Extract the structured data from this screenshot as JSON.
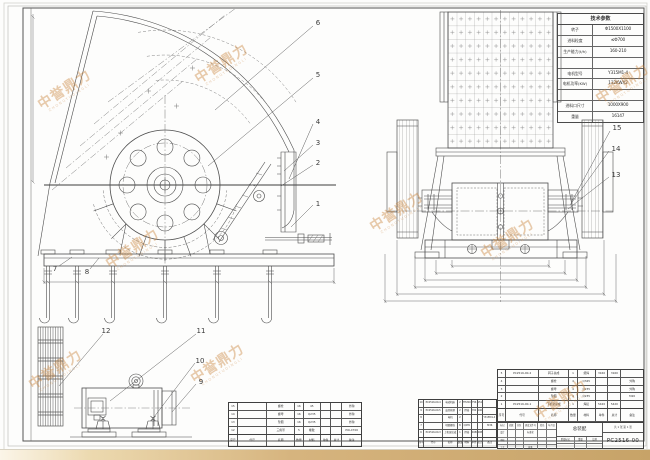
{
  "params": {
    "title": "技术参数",
    "rows": [
      {
        "label": "转子",
        "value": "Φ1500X1100"
      },
      {
        "label": "进料粒度",
        "value": "≤Φ700"
      },
      {
        "label": "生产能力(t/h)",
        "value": "160-210"
      },
      {
        "label": "",
        "value": ""
      },
      {
        "label": "电机型号",
        "value": "Y315M1-4"
      },
      {
        "label": "电机功率(KW)",
        "value": "132KWX2"
      },
      {
        "label": "",
        "value": ""
      },
      {
        "label": "进料口尺寸",
        "value": "1000X900"
      },
      {
        "label": "重量",
        "value": "16147"
      }
    ]
  },
  "bom_header": [
    "序号",
    "代号",
    "名称",
    "数量",
    "材料",
    "单件",
    "总计",
    "备注"
  ],
  "bom_left": {
    "rows": [
      {
        "no": "15",
        "code": "",
        "name": "螺栓",
        "qty": "16",
        "mat": "45",
        "w1": "",
        "w2": "",
        "note": "外购"
      },
      {
        "no": "14",
        "code": "",
        "name": "螺母",
        "qty": "16",
        "mat": "Q235",
        "w1": "",
        "w2": "",
        "note": "外购"
      },
      {
        "no": "13",
        "code": "",
        "name": "垫圈",
        "qty": "16",
        "mat": "Q235",
        "w1": "",
        "w2": "",
        "note": "外购"
      },
      {
        "no": "12",
        "code": "",
        "name": "三角带",
        "qty": "5",
        "mat": "橡胶",
        "w1": "",
        "w2": "",
        "note": "POLX700"
      }
    ]
  },
  "bom_mid": {
    "rows": [
      {
        "no": "10",
        "code": "PC2516-00-4",
        "name": "电动机座",
        "qty": "2",
        "mat": "HT200",
        "w1": "756",
        "w2": "1512",
        "note": ""
      },
      {
        "no": "9",
        "code": "PC2516-00-5",
        "name": "皮带轮罩",
        "qty": "2",
        "mat": "焊接",
        "w1": "702",
        "w2": "1404",
        "note": ""
      },
      {
        "no": "8",
        "code": "",
        "name": "电机",
        "qty": "2",
        "mat": "",
        "w1": "",
        "w2": "",
        "note": "Y315M1-4 132KW"
      },
      {
        "no": "7",
        "code": "",
        "name": "地脚螺栓",
        "qty": "8",
        "mat": "Q235",
        "w1": "",
        "w2": "",
        "note": "M36"
      },
      {
        "no": "6",
        "code": "PC2516-00-3",
        "name": "上机架总成",
        "qty": "1",
        "mat": "焊接",
        "w1": "4080",
        "w2": "4080",
        "note": ""
      }
    ]
  },
  "bom_right": {
    "rows": [
      {
        "no": "5",
        "code": "PC2516-00-2",
        "name": "转子总成",
        "qty": "1",
        "mat": "组焊",
        "w1": "3160",
        "w2": "3160",
        "note": ""
      },
      {
        "no": "4",
        "code": "",
        "name": "螺栓",
        "qty": "4",
        "mat": "Q345",
        "w1": "",
        "w2": "",
        "note": "外购"
      },
      {
        "no": "3",
        "code": "",
        "name": "螺母",
        "qty": "4",
        "mat": "Q235",
        "w1": "",
        "w2": "",
        "note": "外购"
      },
      {
        "no": "2",
        "code": "",
        "name": "垫圈",
        "qty": "4",
        "mat": "Q235",
        "w1": "",
        "w2": "",
        "note": "M20"
      },
      {
        "no": "1",
        "code": "PC2516-00-1",
        "name": "下机架总成",
        "qty": "1",
        "mat": "焊接",
        "w1": "5420",
        "w2": "5420",
        "note": ""
      }
    ]
  },
  "title_block": {
    "name": "总装配",
    "drawing_no": "PC2516-00",
    "sheet_note": "共 1 张 第 1 张",
    "rev_headers": [
      "标记",
      "处数",
      "分区",
      "更改文件号",
      "签名",
      "年月日"
    ],
    "sig": [
      "设计",
      "审核",
      "工艺",
      "批准",
      "标准化"
    ],
    "stage": [
      "阶段标记",
      "重量",
      "比例"
    ]
  },
  "callouts": {
    "items": [
      {
        "label": "6",
        "x": 318,
        "y": 23
      },
      {
        "label": "5",
        "x": 318,
        "y": 75
      },
      {
        "label": "4",
        "x": 318,
        "y": 122
      },
      {
        "label": "3",
        "x": 318,
        "y": 143
      },
      {
        "label": "2",
        "x": 318,
        "y": 163
      },
      {
        "label": "1",
        "x": 318,
        "y": 204
      },
      {
        "label": "7",
        "x": 55,
        "y": 269
      },
      {
        "label": "8",
        "x": 87,
        "y": 272
      },
      {
        "label": "12",
        "x": 106,
        "y": 331
      },
      {
        "label": "11",
        "x": 201,
        "y": 331
      },
      {
        "label": "10",
        "x": 200,
        "y": 361
      },
      {
        "label": "9",
        "x": 201,
        "y": 382
      },
      {
        "label": "15",
        "x": 617,
        "y": 128
      },
      {
        "label": "14",
        "x": 616,
        "y": 149
      },
      {
        "label": "13",
        "x": 616,
        "y": 175
      }
    ]
  },
  "watermark": {
    "cn": "中誉鼎力",
    "en": "ZHONGYUDINGLI",
    "instances": [
      {
        "x": 66,
        "y": 92
      },
      {
        "x": 223,
        "y": 66
      },
      {
        "x": 624,
        "y": 86
      },
      {
        "x": 134,
        "y": 251
      },
      {
        "x": 57,
        "y": 372
      },
      {
        "x": 219,
        "y": 366
      },
      {
        "x": 398,
        "y": 214
      },
      {
        "x": 509,
        "y": 241
      },
      {
        "x": 562,
        "y": 402
      }
    ]
  }
}
